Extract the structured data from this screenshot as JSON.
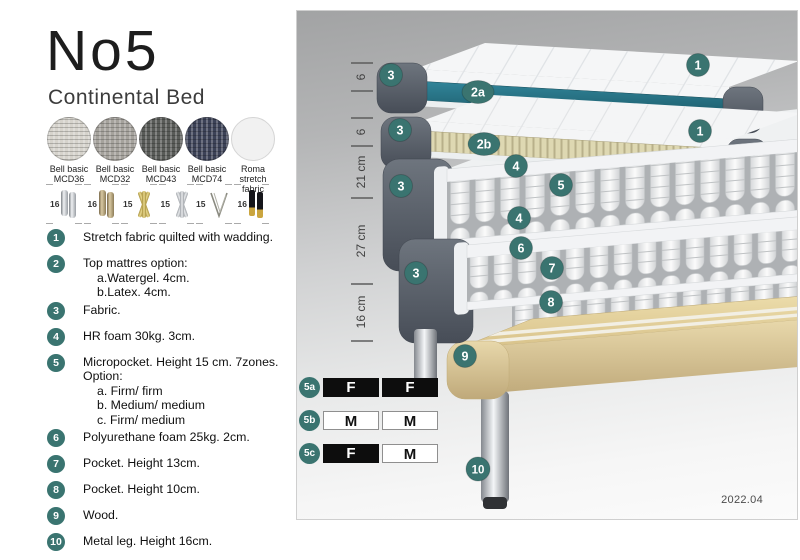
{
  "header": {
    "title": "No5",
    "subtitle": "Continental Bed"
  },
  "fabrics": [
    {
      "line1": "Bell basic",
      "line2": "MCD36"
    },
    {
      "line1": "Bell basic",
      "line2": "MCD32"
    },
    {
      "line1": "Bell basic",
      "line2": "MCD43"
    },
    {
      "line1": "Bell basic",
      "line2": "MCD74"
    },
    {
      "line1": "Roma",
      "line2": "stretch fabric"
    }
  ],
  "legs": [
    {
      "height": "16",
      "type": "cylinder-silver"
    },
    {
      "height": "16",
      "type": "cylinder-bronze"
    },
    {
      "height": "15",
      "type": "twisted-gold"
    },
    {
      "height": "15",
      "type": "twisted-silver"
    },
    {
      "height": "15",
      "type": "hairpin"
    },
    {
      "height": "16",
      "type": "black-gold"
    }
  ],
  "spec_items": [
    {
      "num": "1",
      "lines": [
        "Stretch fabric quilted with wadding."
      ]
    },
    {
      "num": "2",
      "lines": [
        "Top mattres option:",
        "a.Watergel. 4cm.",
        "b.Latex. 4cm."
      ]
    },
    {
      "num": "3",
      "lines": [
        "Fabric."
      ]
    },
    {
      "num": "4",
      "lines": [
        "HR foam 30kg. 3cm."
      ]
    },
    {
      "num": "5",
      "lines": [
        "Micropocket. Height 15 cm. 7zones. Option:",
        "a. Firm/ firm",
        "b. Medium/ medium",
        "c. Firm/ medium"
      ]
    },
    {
      "num": "6",
      "lines": [
        "Polyurethane foam 25kg. 2cm."
      ]
    },
    {
      "num": "7",
      "lines": [
        "Pocket. Height 13cm."
      ]
    },
    {
      "num": "8",
      "lines": [
        "Pocket. Height 10cm."
      ]
    },
    {
      "num": "9",
      "lines": [
        "Wood."
      ]
    },
    {
      "num": "10",
      "lines": [
        "Metal leg. Height 16cm."
      ]
    }
  ],
  "diagram": {
    "dims": [
      "6",
      "6",
      "21 cm",
      "27 cm",
      "16 cm"
    ],
    "badges": {
      "n1": "1",
      "n2a": "2a",
      "n2b": "2b",
      "n3": "3",
      "n4": "4",
      "n5": "5",
      "n6": "6",
      "n7": "7",
      "n8": "8",
      "n9": "9",
      "n10": "10"
    },
    "firmness": [
      {
        "label": "5a",
        "cells": [
          {
            "text": "F"
          },
          {
            "text": "F"
          }
        ]
      },
      {
        "label": "5b",
        "cells": [
          {
            "text": "M"
          },
          {
            "text": "M"
          }
        ]
      },
      {
        "label": "5c",
        "cells": [
          {
            "text": "F"
          },
          {
            "text": "M"
          }
        ]
      }
    ],
    "version": "2022.04"
  },
  "colors": {
    "badge_teal": "#3a7470",
    "core_teal": "#2c7b8b",
    "fabric_dark_gray": "#575d66",
    "wood_beige": "#e2d2a4",
    "mcd36": "#d6d3cc",
    "mcd32": "#a5a29c",
    "mcd43": "#595b58",
    "mcd74": "#3c4257",
    "roma_white": "#f1f1f1"
  }
}
